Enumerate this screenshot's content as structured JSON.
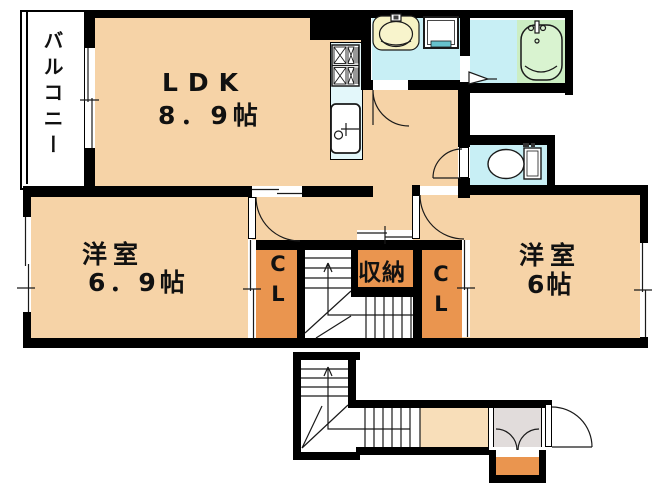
{
  "plan": {
    "balcony_label": "バルコニー",
    "ldk": {
      "name": "LDK",
      "size": "8．9帖"
    },
    "room1": {
      "name": "洋室",
      "size": "6．9帖"
    },
    "room2": {
      "name": "洋室",
      "size": "6帖"
    },
    "closet1_label": "CL",
    "closet2_label": "CL",
    "storage_label": "収納",
    "colors": {
      "wall": "#000000",
      "room_floor": "#F6D3A7",
      "corridor_floor": "#F8DEB9",
      "closet": "#EA954F",
      "wet_floor": "#C8EFF5",
      "kitchen_counter": "#E3F7FA",
      "tub_area": "#CCEEC3",
      "vanity": "#F6F2C4",
      "entry_floor": "#E1DCDB"
    }
  }
}
